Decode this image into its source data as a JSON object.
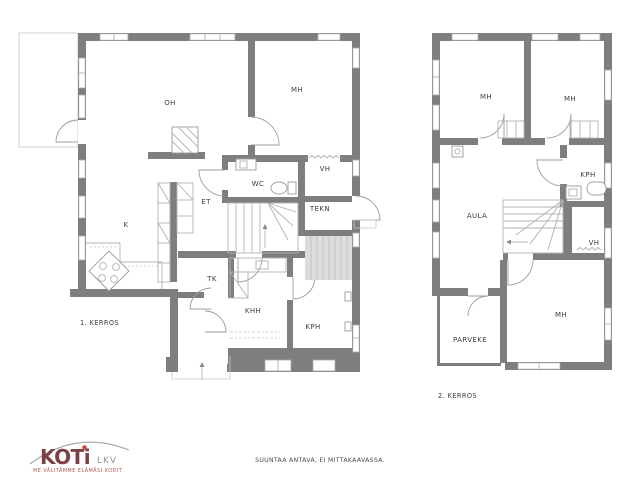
{
  "floor1": {
    "caption": "1. KERROS",
    "rooms": {
      "oh": "OH",
      "mh": "MH",
      "vh": "VH",
      "wc": "WC",
      "tekn": "TEKN",
      "et": "ET",
      "k": "K",
      "tk": "TK",
      "khh": "KHH",
      "kph": "KPH"
    }
  },
  "floor2": {
    "caption": "2. KERROS",
    "rooms": {
      "mh_top_left": "MH",
      "mh_top_right": "MH",
      "kph": "KPH",
      "aula": "AULA",
      "vh": "VH",
      "mh_bottom": "MH",
      "parveke": "PARVEKE"
    }
  },
  "logo": {
    "brand": "KOTi",
    "suffix": "LKV",
    "tagline": "ME VÄLITÄMME ELÄMÄSI KODIT",
    "brand_color": "#7c4145",
    "suffix_color": "#8f9195",
    "tagline_color": "#b2534e"
  },
  "footer": {
    "note": "SUUNTAA ANTAVA, EI MITTAKAAVASSA."
  },
  "colors": {
    "wall": "#7e7e7e",
    "thin_line": "#b3b3b3",
    "label": "#3d3d3d"
  }
}
